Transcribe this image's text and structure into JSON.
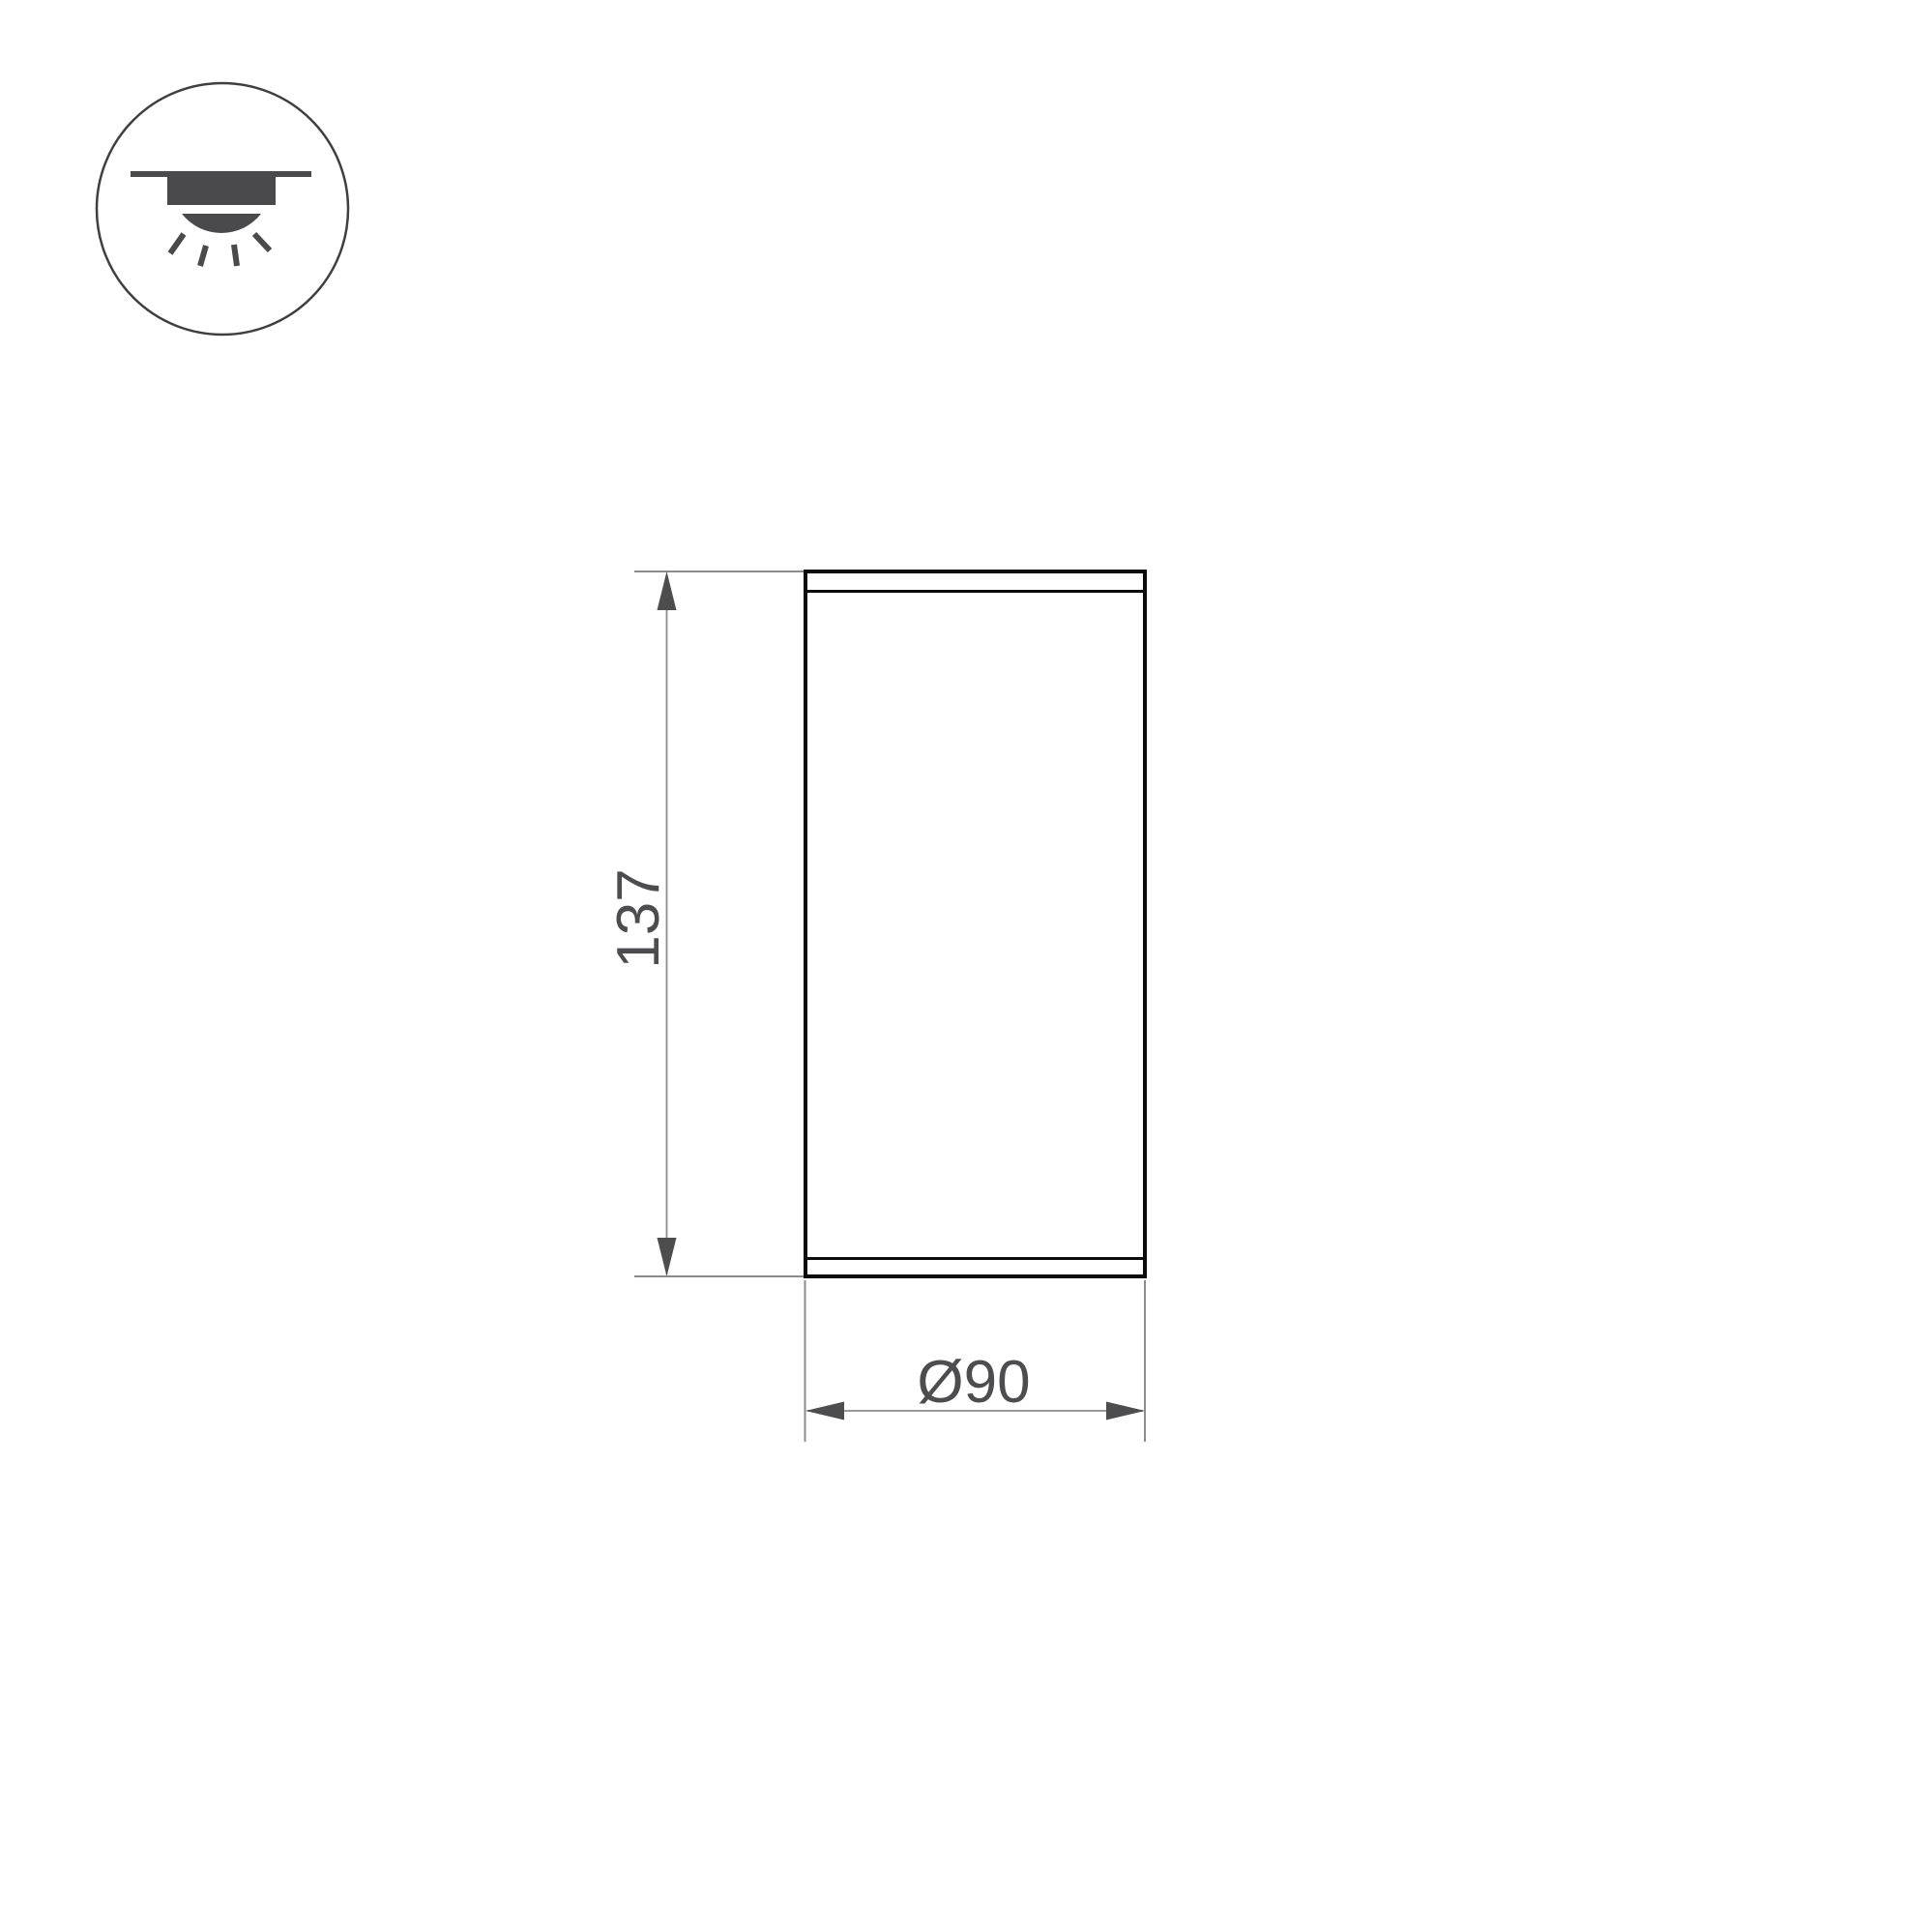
{
  "page": {
    "background": "#ffffff",
    "description_labels": {
      "height_label": "137",
      "diameter_label": "Ø90"
    }
  },
  "icon": {
    "name": "surface-mounted-downlight-icon",
    "stroke_color": "#3f3f41",
    "fill_color": "#4a4a4c"
  },
  "drawing": {
    "height_label": "137",
    "diameter_label": "Ø90",
    "colors": {
      "outline": "#0b0b0b",
      "dimension_line": "#8c8c8c",
      "annotation": "#4d4d4f"
    }
  }
}
